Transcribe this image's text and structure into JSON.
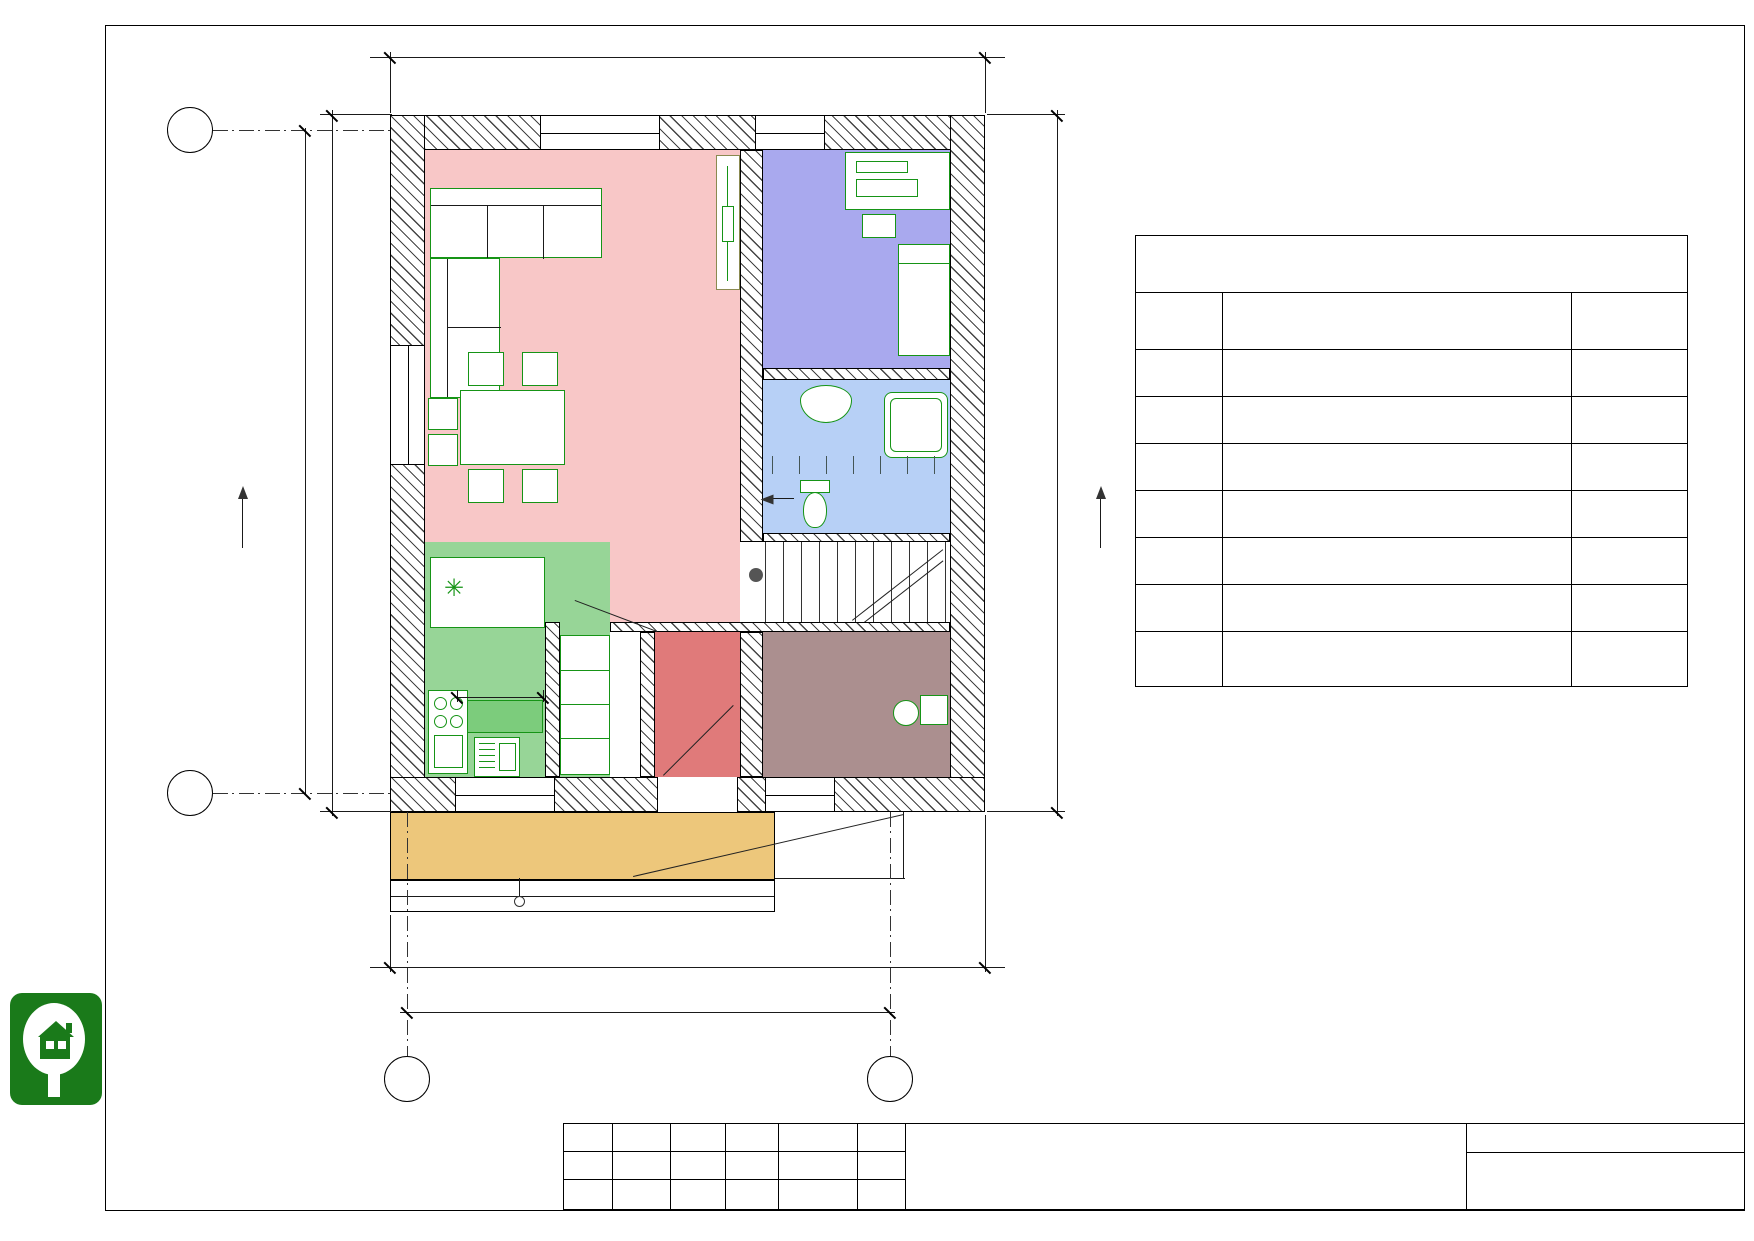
{
  "colors": {
    "living": "#f8c7c7",
    "cabinet": "#a9a9ee",
    "bathroom": "#b7d0f6",
    "kitchen": "#97d597",
    "tambour": "#e07a7a",
    "boiler_room": "#ab8f8f",
    "terrace": "#edc77b",
    "furniture_green": "#169416",
    "logo_green": "#1a7a1a"
  },
  "axes": {
    "top_left": "Б",
    "bottom_left": "А",
    "col1": "1",
    "col2": "2",
    "section": "1"
  },
  "dims": {
    "top": "7 660",
    "left_outer": "8 000",
    "left_inner": "8 860",
    "right": "8 860",
    "bottom_outer": "7 660",
    "bottom_inner": "6 800",
    "kitchen_island": "1 030",
    "stairs_note": "14 х 218 = 3 050"
  },
  "windows": {
    "ok3": {
      "name": "ОК-3",
      "size": "1 600 х 2 100"
    },
    "ok4": {
      "name": "ОК-4",
      "size": "900 х 2 100"
    },
    "ok5": {
      "name": "ОК-5",
      "size": "1 600 х 2 100"
    },
    "ok1": {
      "name": "ОК-1",
      "size": "1 300 х 1 400"
    },
    "ok2": {
      "name": "ОК-2",
      "size": "900 х 1 400"
    }
  },
  "rooms": {
    "living": {
      "name": "Гостиная с кухонной зоной",
      "num": "5",
      "area": "21,51 м²"
    },
    "cabinet": {
      "name": "Кабинет",
      "num": "4",
      "area": "7,14 м²"
    },
    "bathroom": {
      "name": "Санузел",
      "num": "3",
      "area": "4,94 м²"
    },
    "kitchen": {
      "name": "Кухня",
      "num": "6",
      "area": "7,04 м²"
    },
    "tambour": {
      "name": "Тамбур",
      "num": "1",
      "area": "2,86 м²"
    },
    "boiler": {
      "name": "Котельная",
      "num": "2",
      "area": "4,85 м²"
    }
  },
  "terrace": {
    "area": "5,29 м²"
  },
  "explication": {
    "title": "Экспликация 1-й этаж",
    "columns": {
      "num": "№",
      "name": "Наименование",
      "area": "S, м2"
    },
    "rows": [
      {
        "num": "1",
        "name": "Тамбур",
        "area": "2,86"
      },
      {
        "num": "2",
        "name": "Котельная",
        "area": "4,85"
      },
      {
        "num": "3",
        "name": "Санузел",
        "area": "4,94"
      },
      {
        "num": "4",
        "name": "Кабинет",
        "area": "7,14"
      },
      {
        "num": "5",
        "name": "Гостиная с кухонной зоной",
        "area": "21,51"
      },
      {
        "num": "6",
        "name": "Кухня",
        "area": "7,04"
      }
    ],
    "total": "48,34 м²"
  },
  "titleblock": {
    "cols": [
      "Изм.",
      "Кол.уч.",
      "Лист",
      "№Док.",
      "Подп.",
      "Дата"
    ],
    "doc_title": "План мебели на отм. +0,000",
    "sheet_label": "Лист",
    "sheet_number": "2",
    "doc_code": "DH.AP.32.13.12.2018"
  },
  "logo": {
    "line1": "Dream",
    "line2": "house"
  }
}
